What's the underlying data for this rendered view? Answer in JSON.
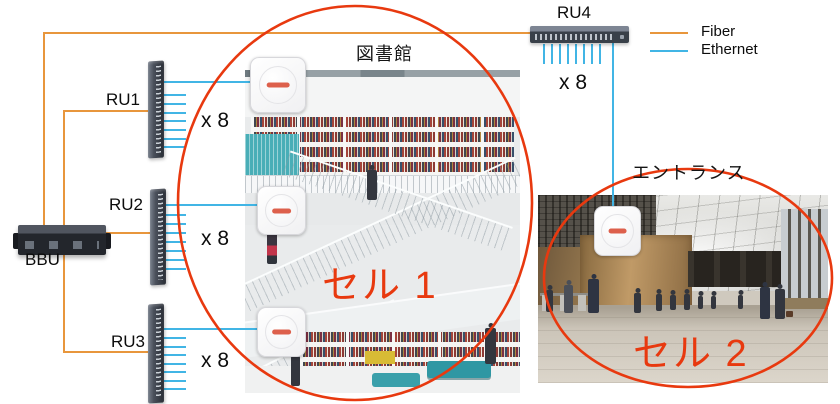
{
  "colors": {
    "fiber": "#E8963C",
    "ethernet": "#41B5E5",
    "cell_red": "#E8390F"
  },
  "legend": {
    "fiber_label": "Fiber",
    "ethernet_label": "Ethernet"
  },
  "nodes": {
    "bbu": {
      "label": "BBU"
    },
    "ru1": {
      "label": "RU1",
      "multiplier": "x 8"
    },
    "ru2": {
      "label": "RU2",
      "multiplier": "x 8"
    },
    "ru3": {
      "label": "RU3",
      "multiplier": "x 8"
    },
    "ru4": {
      "label": "RU4",
      "multiplier": "x 8"
    }
  },
  "areas": {
    "library": {
      "title": "図書館",
      "cell_label": "セル 1"
    },
    "entrance": {
      "title": "エントランス",
      "cell_label": "セル 2"
    }
  }
}
